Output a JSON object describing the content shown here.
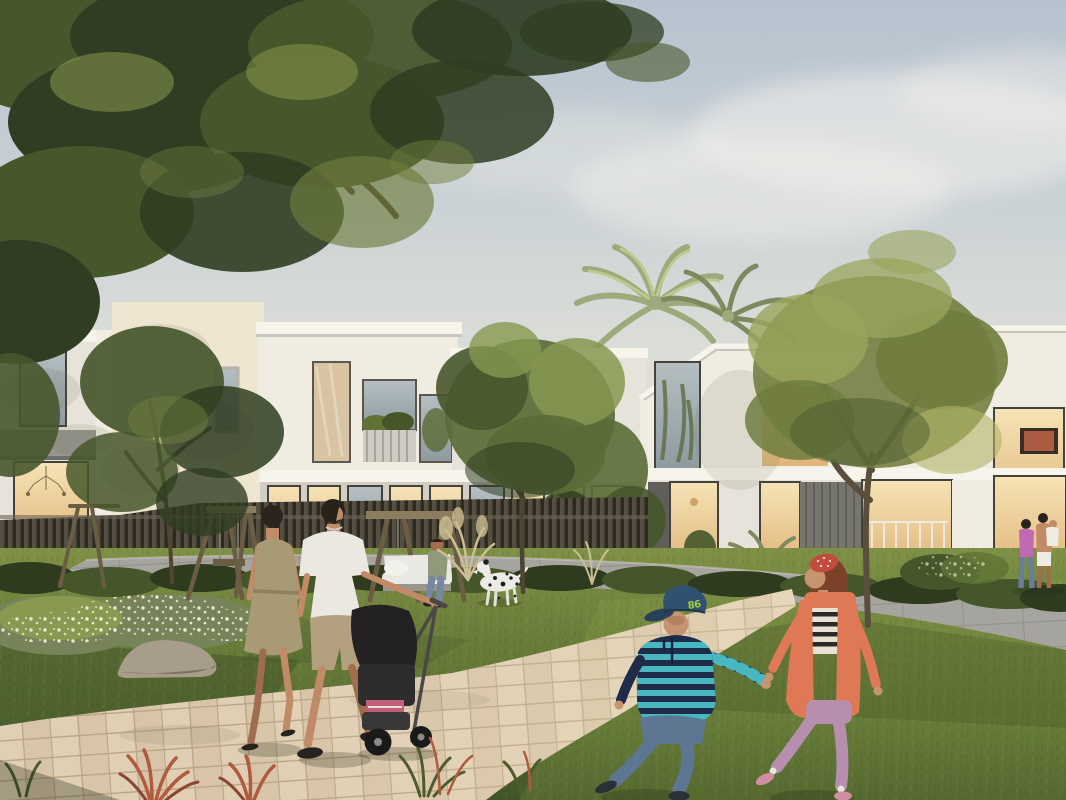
{
  "scene": {
    "type": "architectural-render-photo",
    "description": "Golden-hour rendering of a modern white townhouse community. A couple pushes a black stroller along a curved beige paver path; two children holding hands run across the lawn in front; a dalmatian and a person on a wooden swing-bench sit by a slatted fence; palms and mature trees stand between the two-storey villas; a small family chats on the right lawn.",
    "cap_text": "86",
    "elements": [
      "sky",
      "clouds",
      "sun-glow",
      "palm-trees",
      "villa-left",
      "villa-center",
      "villa-right",
      "slat-fence",
      "hedges",
      "lawn",
      "concrete-path",
      "paver-path",
      "flower-bed",
      "rock",
      "swing-frame",
      "swing-bench",
      "bench-sitter",
      "dalmatian-dog",
      "walking-woman",
      "walking-man",
      "stroller",
      "running-boy",
      "running-girl",
      "background-family",
      "red-foreground-plants",
      "big-tree-canopy",
      "middle-tree",
      "right-tree"
    ]
  },
  "palette": {
    "skyTop": "#b6c2cf",
    "skyMid": "#ccd3d6",
    "skyLow": "#e2e1d8",
    "skyHorizon": "#f0e9d6",
    "cloud": "#f3f1ec",
    "glow": "#ffdf9e",
    "wallLight": "#f1ece1",
    "wallWhite": "#e7e3da",
    "wallShade": "#d2cec5",
    "wallWarm": "#efe6d2",
    "roofEdge": "#f7f4ec",
    "roofShadow": "#bdb9b0",
    "accentGrey": "#97958f",
    "darkGrey": "#5f5e59",
    "pillarGrey": "#77766f",
    "glassTop": "#b5bfc2",
    "glassBot": "#8e9a9e",
    "warmTop": "#f6e3b6",
    "warmBot": "#dfb478",
    "frameDark": "#44423c",
    "canopyDark": "#2f3d22",
    "canopyMid": "#47572c",
    "canopyLight": "#6d7d3c",
    "canopyHi": "#94a352",
    "treeMid": "#5a6b36",
    "treeMidHi": "#869850",
    "treeRight": "#6f7c3e",
    "treeRightHi": "#9aa55c",
    "treeRightWarm": "#b3b468",
    "palm": "#9dab7c",
    "palmHi": "#bec98f",
    "palmShade": "#7d8a60",
    "hedgeDark": "#2e3b1f",
    "hedge": "#44562a",
    "hedgeHi": "#5f7434",
    "lawnBack": "#7f9146",
    "lawnMid": "#6d803c",
    "lawnFront": "#5a6f33",
    "lawnShadow": "#415427",
    "lawnSun": "#8ba04c",
    "paver": "#d8c5a9",
    "paverLight": "#e0cfb4",
    "paverJoint": "#b9a584",
    "concrete": "#a6a49e",
    "concreteJoint": "#94928b",
    "rock": "#a89c8a",
    "rockShade": "#7e7363",
    "flowerWhite": "#eeeade",
    "shrubGrey": "#77845a",
    "redPlant": "#b05a3e",
    "redPlantDark": "#8a4630",
    "pampas": "#cdbd92",
    "wood": "#8d7d5f",
    "woodDark": "#6b5d44",
    "skin": "#c08b66",
    "skinShade": "#a06e4e",
    "shoeDark": "#26231f",
    "womanDress": "#a79a74",
    "womanHair": "#2b241e",
    "beltTone": "#8d805e",
    "manShirt": "#ebe8e1",
    "manShorts": "#b3a07f",
    "manHair": "#2a211b",
    "strollerDark": "#232122",
    "strollerBody": "#2e2c2d",
    "strollerGrey": "#4a4746",
    "strollerPink": "#c2607c",
    "wheel": "#1b1a1a",
    "hub": "#8d8a86",
    "boyCap": "#315170",
    "boyCapBrim": "#27415c",
    "capBadge": "#9fcf3a",
    "boyStripeA": "#49b7c0",
    "boyStripeB": "#1f2c49",
    "boyJeans": "#5d7691",
    "boySkin": "#c79470",
    "girlBand": "#c14b3e",
    "girlHair": "#7c4229",
    "girlTop": "#e9e2d2",
    "girlTopStripe": "#2c2a28",
    "girlCardigan": "#df7855",
    "girlPants": "#b78fae",
    "girlShoe": "#cf8fa0",
    "sock": "#e8e4de",
    "dogWhite": "#ecebe6",
    "dogSpot": "#1f1e1c",
    "benchCushion": "#e9e8e3",
    "sitterShirt": "#8f9a7a",
    "sitterJeans": "#7588a0",
    "bgPink": "#bf6ab2",
    "bgJeans": "#697e95",
    "bgWhite": "#efece4"
  }
}
